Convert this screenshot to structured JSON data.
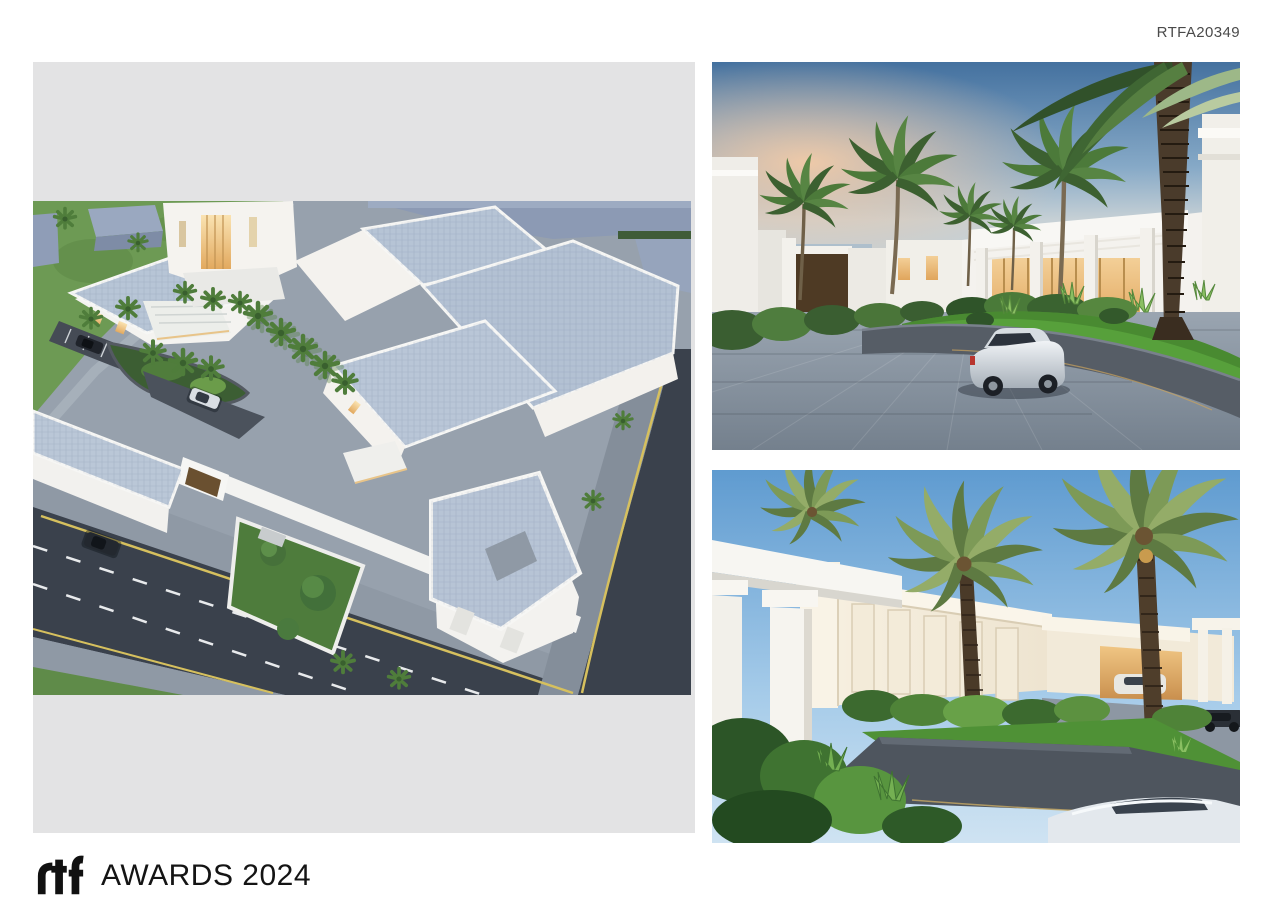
{
  "page": {
    "background": "#ffffff",
    "submission_code": "RTFA20349"
  },
  "footer": {
    "logo_name": "rtf-awards-logo",
    "awards_text": "AWARDS 2024"
  },
  "board": {
    "backdrop_color": "#e3e3e4",
    "images": [
      {
        "id": "aerial-masterplan-render",
        "alt": "Aerial dusk render of a white villa compound with pale blue flat roofs, palm gardens, perimeter wall and surrounding asphalt roads"
      },
      {
        "id": "driveway-render",
        "alt": "Dusk render of a paver driveway with a parked silver car, curved grey planter wall, bright lawn, palms and a white pavilion villa"
      },
      {
        "id": "entrance-colonnade-render",
        "alt": "Render of a villa entrance with white colonnade, cream classical facade, tall date palms, tropical planting, garage and cars"
      }
    ],
    "palette": {
      "roof_blue": "#b5c3d5",
      "asphalt": "#3a414c",
      "paver_grey": "#939ea9",
      "planter_grey": "#545b64",
      "lawn_green": "#55a03b",
      "dusk_sky_top": "#44719f",
      "dusk_horizon": "#eec9a8",
      "day_sky": "#5f9bd0",
      "warm_glow": "#f2cf97"
    }
  }
}
